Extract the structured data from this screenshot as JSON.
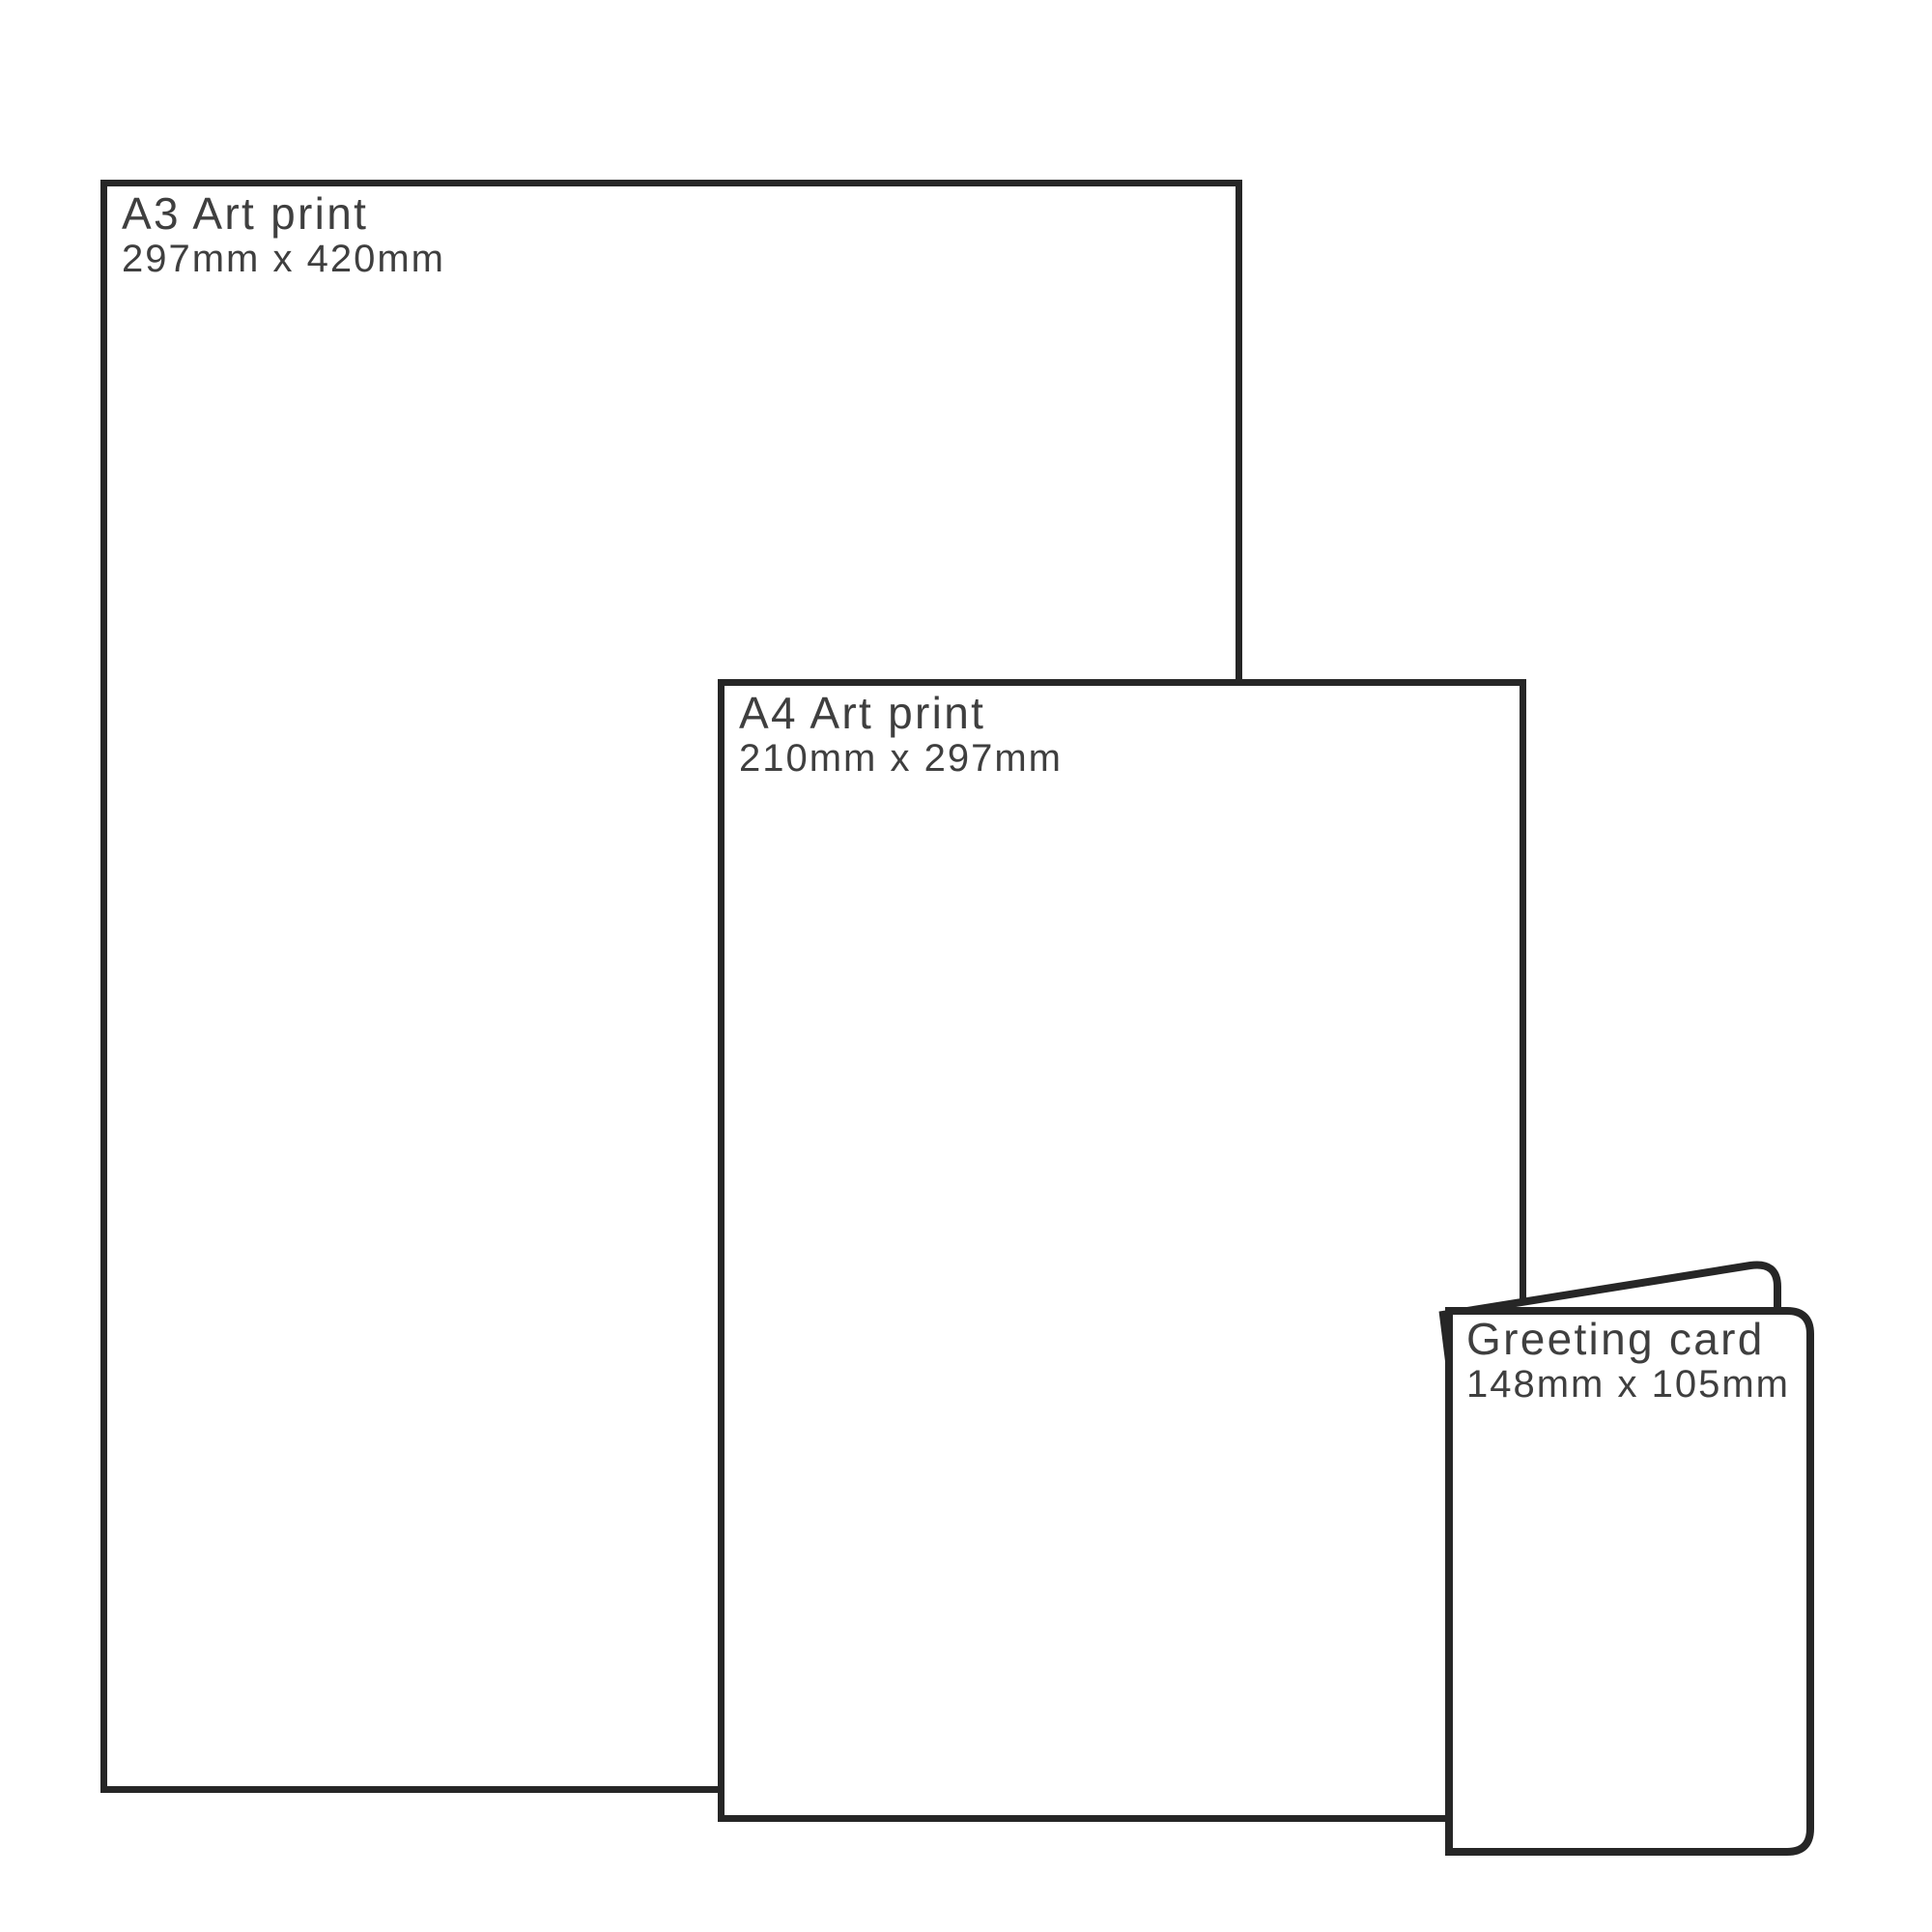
{
  "diagram": {
    "background_color": "#ffffff",
    "line_color": "#262626",
    "text_color": "#3f3f3f"
  },
  "items": [
    {
      "id": "a3-art-print",
      "title": "A3 Art print",
      "dimensions": "297mm x 420mm"
    },
    {
      "id": "a4-art-print",
      "title": "A4 Art print",
      "dimensions": "210mm x 297mm"
    },
    {
      "id": "greeting-card",
      "title": "Greeting card",
      "dimensions": "148mm x 105mm"
    }
  ]
}
